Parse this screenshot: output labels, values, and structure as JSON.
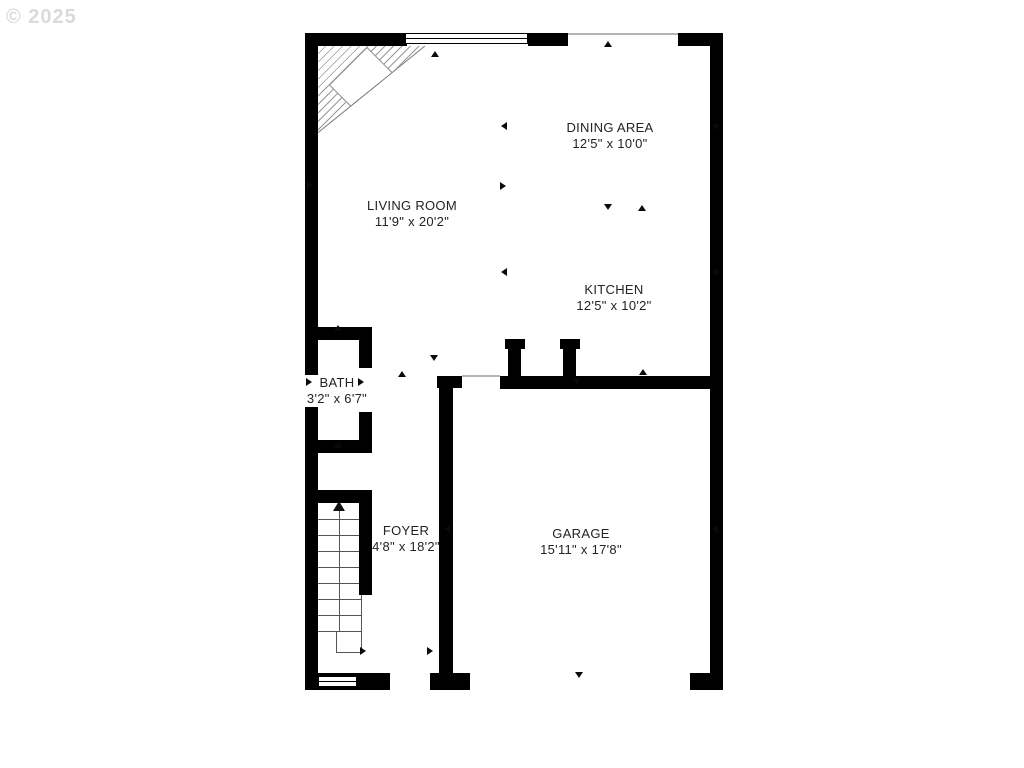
{
  "watermark": "© 2025",
  "rooms": {
    "dining": {
      "name": "DINING AREA",
      "dims": "12'5\" x 10'0\""
    },
    "living": {
      "name": "LIVING ROOM",
      "dims": "11'9\" x 20'2\""
    },
    "kitchen": {
      "name": "KITCHEN",
      "dims": "12'5\" x 10'2\""
    },
    "bath": {
      "name": "BATH",
      "dims": "3'2\" x 6'7\""
    },
    "foyer": {
      "name": "FOYER",
      "dims": "4'8\" x 18'2\""
    },
    "garage": {
      "name": "GARAGE",
      "dims": "15'11\" x 17'8\""
    }
  },
  "colors": {
    "wall": "#000000",
    "text": "#232323",
    "watermark": "#dadada",
    "thin_line": "#b5b5b5"
  },
  "stairs": {
    "tread_count": 8
  },
  "markers": [
    {
      "x": 604,
      "y": 41,
      "d": "up"
    },
    {
      "x": 431,
      "y": 51,
      "d": "up"
    },
    {
      "x": 501,
      "y": 122,
      "d": "left"
    },
    {
      "x": 712,
      "y": 122,
      "d": "left"
    },
    {
      "x": 307,
      "y": 181,
      "d": "right"
    },
    {
      "x": 500,
      "y": 182,
      "d": "right"
    },
    {
      "x": 604,
      "y": 204,
      "d": "down"
    },
    {
      "x": 638,
      "y": 205,
      "d": "up"
    },
    {
      "x": 501,
      "y": 268,
      "d": "left"
    },
    {
      "x": 712,
      "y": 268,
      "d": "left"
    },
    {
      "x": 334,
      "y": 325,
      "d": "up"
    },
    {
      "x": 306,
      "y": 378,
      "d": "right"
    },
    {
      "x": 358,
      "y": 378,
      "d": "right"
    },
    {
      "x": 398,
      "y": 371,
      "d": "up"
    },
    {
      "x": 430,
      "y": 355,
      "d": "down"
    },
    {
      "x": 334,
      "y": 442,
      "d": "up"
    },
    {
      "x": 573,
      "y": 379,
      "d": "down"
    },
    {
      "x": 639,
      "y": 369,
      "d": "up"
    },
    {
      "x": 444,
      "y": 525,
      "d": "left"
    },
    {
      "x": 712,
      "y": 525,
      "d": "left"
    },
    {
      "x": 360,
      "y": 647,
      "d": "right"
    },
    {
      "x": 427,
      "y": 647,
      "d": "right"
    },
    {
      "x": 575,
      "y": 672,
      "d": "down"
    }
  ]
}
